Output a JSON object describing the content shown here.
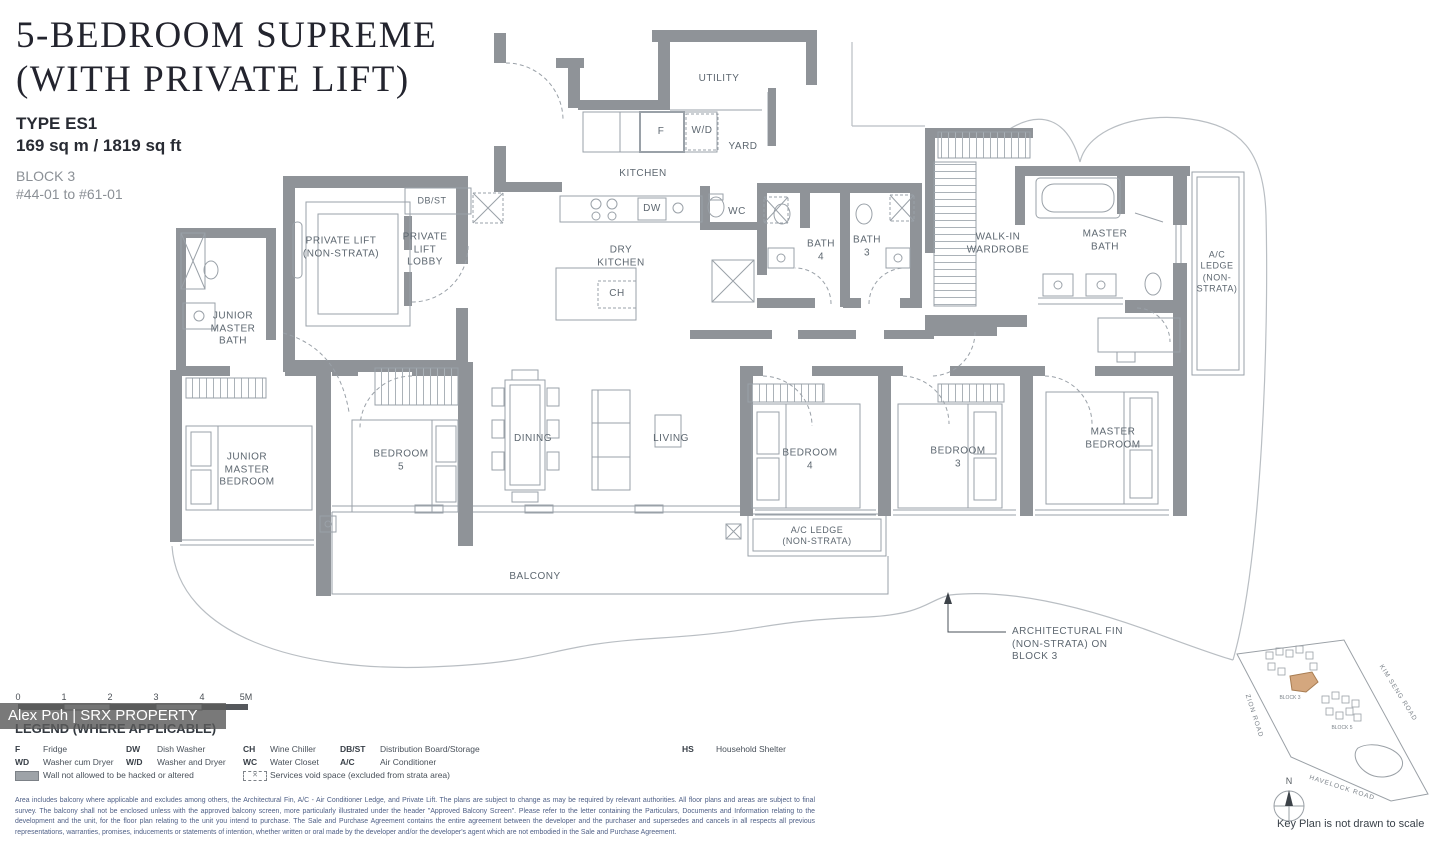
{
  "header": {
    "title_line1": "5-BEDROOM SUPREME",
    "title_line2": "(WITH PRIVATE LIFT)",
    "type": "TYPE ES1",
    "area": "169 sq m / 1819 sq ft",
    "block": "BLOCK 3",
    "units": "#44-01 to #61-01"
  },
  "watermark": "Alex Poh | SRX PROPERTY",
  "plan": {
    "rooms": {
      "utility": "UTILITY",
      "yard": "YARD",
      "kitchen": "KITCHEN",
      "dry_kitchen": "DRY\nKITCHEN",
      "fridge": "F",
      "washer_dryer": "W/D",
      "dishwasher": "DW",
      "wine_chiller": "CH",
      "water_closet": "WC",
      "db_st": "DB/ST",
      "private_lift": "PRIVATE LIFT\n(NON-STRATA)",
      "private_lift_lobby": "PRIVATE\nLIFT\nLOBBY",
      "junior_master_bath": "JUNIOR\nMASTER\nBATH",
      "junior_master_bedroom": "JUNIOR\nMASTER\nBEDROOM",
      "bedroom5": "BEDROOM\n5",
      "dining": "DINING",
      "living": "LIVING",
      "bedroom4": "BEDROOM\n4",
      "bedroom3": "BEDROOM\n3",
      "master_bedroom": "MASTER\nBEDROOM",
      "bath4": "BATH\n4",
      "bath3": "BATH\n3",
      "walk_in_wardrobe": "WALK-IN\nWARDROBE",
      "master_bath": "MASTER\nBATH",
      "ac_ledge_right": "A/C\nLEDGE\n(NON-\nSTRATA)",
      "ac_ledge_bottom": "A/C LEDGE\n(NON-STRATA)",
      "balcony": "BALCONY",
      "arch_fin_note": "ARCHITECTURAL FIN\n(NON-STRATA) ON\nBLOCK 3"
    }
  },
  "scale_bar": {
    "ticks": [
      "0",
      "1",
      "2",
      "3",
      "4",
      "5M"
    ]
  },
  "legend": {
    "heading": "LEGEND (WHERE APPLICABLE)",
    "items": [
      {
        "abbr": "F",
        "label": "Fridge"
      },
      {
        "abbr": "DW",
        "label": "Dish Washer"
      },
      {
        "abbr": "CH",
        "label": "Wine Chiller"
      },
      {
        "abbr": "DB/ST",
        "label": "Distribution Board/Storage"
      },
      {
        "abbr": "HS",
        "label": "Household Shelter"
      },
      {
        "abbr": "WD",
        "label": "Washer cum Dryer"
      },
      {
        "abbr": "W/D",
        "label": "Washer and Dryer"
      },
      {
        "abbr": "WC",
        "label": "Water Closet"
      },
      {
        "abbr": "A/C",
        "label": "Air Conditioner"
      }
    ],
    "symbol_items": [
      {
        "label": "Wall not allowed to be hacked or altered"
      },
      {
        "label": "Services void space (excluded from strata area)"
      }
    ]
  },
  "key_plan": {
    "roads": {
      "zion": "ZION ROAD",
      "kim_seng": "KIM SENG ROAD",
      "havelock": "HAVELOCK ROAD"
    },
    "blocks": {
      "block3": "BLOCK 3",
      "block5": "BLOCK 5"
    },
    "compass_n": "N",
    "note": "Key Plan is not drawn to scale"
  },
  "disclaimer": "Area includes balcony where applicable and excludes among others, the Architectural Fin, A/C - Air Conditioner Ledge, and Private Lift. The plans are subject to change as may be required by relevant authorities. All floor plans and areas are subject to final survey. The balcony shall not be enclosed unless with the approved balcony screen, more particularly illustrated under the header \"Approved Balcony Screen\". Please refer to the letter containing the Particulars, Documents and Information relating to the development and the unit, for the floor plan relating to the unit you intend to purchase. The Sale and Purchase Agreement contains the entire agreement between the developer and the purchaser and supersedes and cancels in all respects all previous representations, warranties, promises, inducements or statements of intention, whether written or oral made by the developer and/or the developer's agent which are not embodied in the Sale and Purchase Agreement."
}
